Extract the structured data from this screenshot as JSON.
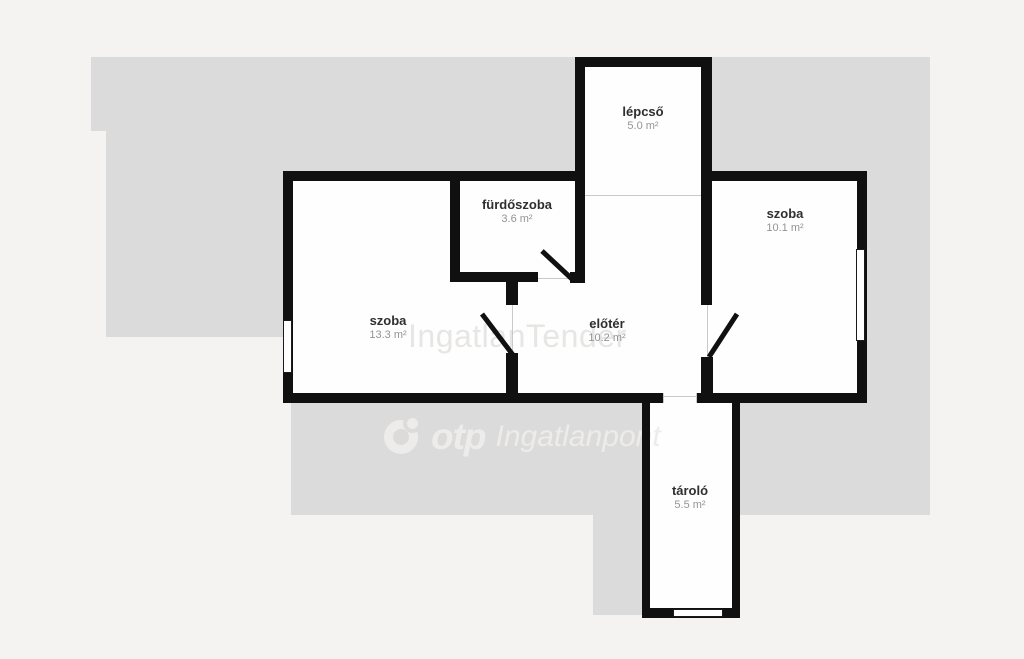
{
  "watermarks": {
    "center": "IngatlanTender",
    "otp_brand": "otp",
    "otp_suffix": "Ingatlanpont"
  },
  "rooms": [
    {
      "name": "lépcső",
      "area": "5.0 m²"
    },
    {
      "name": "fürdőszoba",
      "area": "3.6 m²"
    },
    {
      "name": "szoba",
      "area": "10.1 m²"
    },
    {
      "name": "szoba",
      "area": "13.3 m²"
    },
    {
      "name": "előtér",
      "area": "10.2 m²"
    },
    {
      "name": "tároló",
      "area": "5.5 m²"
    }
  ],
  "colors": {
    "background": "#f4f3f1",
    "silhouette_gray": "#dbdbdb",
    "wall_black": "#101010",
    "floor_white": "#fefefe",
    "room_label": "#2f2f2f",
    "area_label": "#949494",
    "watermark_center": "#e7e6e4",
    "watermark_otp": "#edecea"
  }
}
